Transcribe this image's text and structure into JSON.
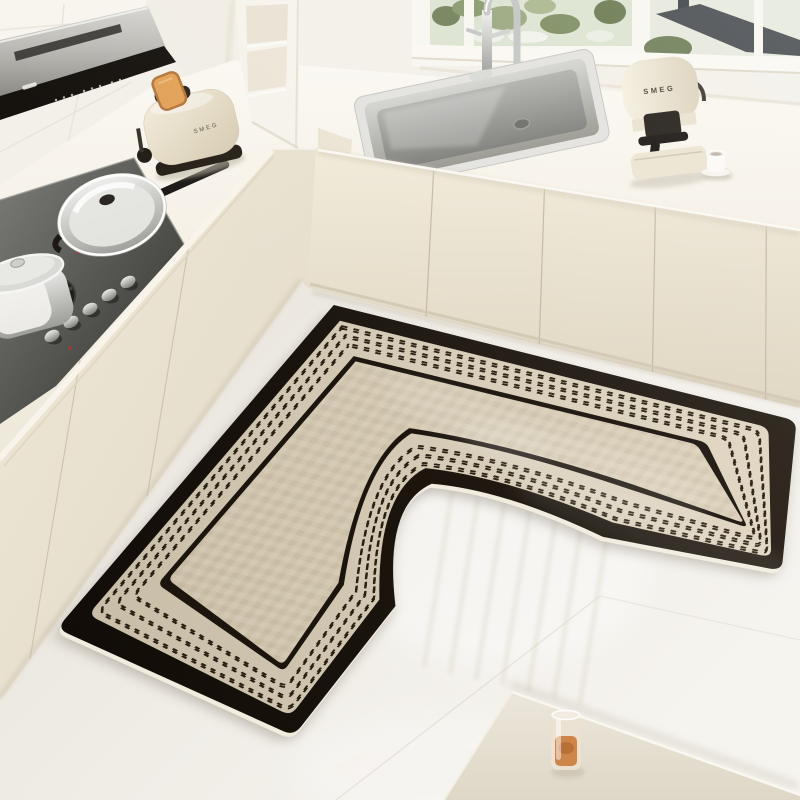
{
  "image": {
    "kind": "kitchen lifestyle product photo",
    "subject": "L-shaped black and cream anti-slip kitchen floor mat in a cream kitchen corner"
  },
  "brands": {
    "toaster": "SMEG",
    "coffee_machine": "SMEG"
  },
  "colors": {
    "mat_black": "#19130d",
    "mat_line": "#1b150e",
    "mat_dash": "#281e11",
    "mat_band_light": "#e3d9c5",
    "mat_band_dark": "#c7bca6",
    "mat_center_light": "#ddd2bc",
    "mat_center_dark": "#c9bda5",
    "mat_edge_light": "#f2ecdf",
    "mat_shadow": "#6a6052",
    "cabinet_cream": "#eee7d8",
    "counter_white": "#f8f5ee",
    "wall_cream": "#f3f0e9",
    "floor_light": "#f2efe9",
    "hob_steel": "#3a3a36",
    "toast_golden": "#e2a258",
    "drink_amber": "#cd8647",
    "window_greenery": "#87976b",
    "roof_slate": "#474b4f"
  }
}
